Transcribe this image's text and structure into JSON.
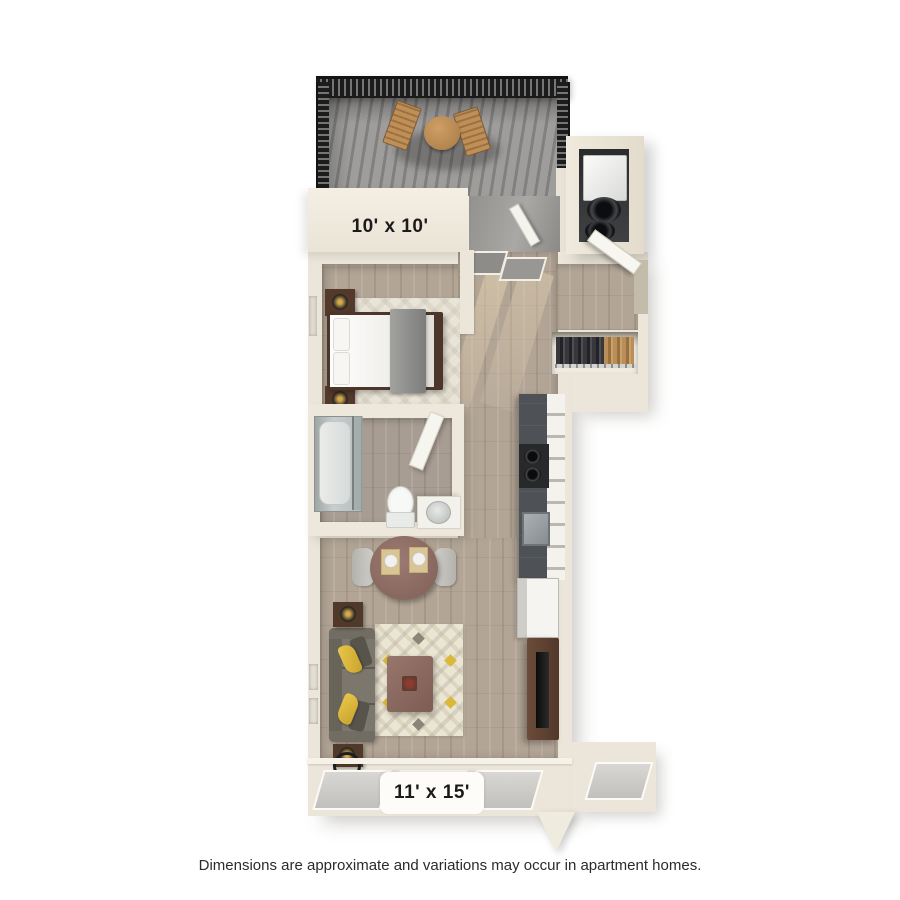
{
  "page": {
    "background_color": "#ffffff",
    "disclaimer": "Dimensions are approximate and variations may occur in apartment homes."
  },
  "floorplan": {
    "view": "3d-top-down-studio-apartment",
    "labels": {
      "patio": "10' x 10'",
      "living_room": "11' x 15'"
    },
    "rooms": [
      {
        "id": "patio",
        "label": "10' x 10'",
        "features": [
          "railing",
          "bistro-table",
          "patio-chairs"
        ]
      },
      {
        "id": "laundry-closet",
        "features": [
          "stacked-washer-dryer"
        ]
      },
      {
        "id": "entry",
        "features": [
          "entry-door",
          "glass-panels"
        ]
      },
      {
        "id": "sleeping-area",
        "features": [
          "bed",
          "nightstand-lamps",
          "rug"
        ]
      },
      {
        "id": "closet",
        "features": [
          "hanging-clothes",
          "closet-rod"
        ]
      },
      {
        "id": "bathroom",
        "features": [
          "tub-shower",
          "toilet",
          "vanity-sink",
          "door"
        ]
      },
      {
        "id": "kitchen",
        "features": [
          "counter",
          "range",
          "sink",
          "refrigerator",
          "cabinets"
        ]
      },
      {
        "id": "dining-area",
        "features": [
          "round-table",
          "chairs",
          "place-settings"
        ]
      },
      {
        "id": "living-room",
        "label": "11' x 15'",
        "features": [
          "sofa",
          "yellow-pillows",
          "end-table-lamps",
          "coffee-table",
          "area-rug",
          "tv-console",
          "television",
          "windows"
        ]
      }
    ],
    "colors": {
      "wall": "#ece6da",
      "wood_floor": "#b2a596",
      "patio_floor": "#9e9d9b",
      "railing": "#232323",
      "counter": "#4e5155",
      "sofa": "#7c776c",
      "accent_yellow": "#e0bc43",
      "table_wood": "#8f6e65",
      "console_wood": "#5d4233",
      "label_text": "#1b1b1b"
    }
  }
}
